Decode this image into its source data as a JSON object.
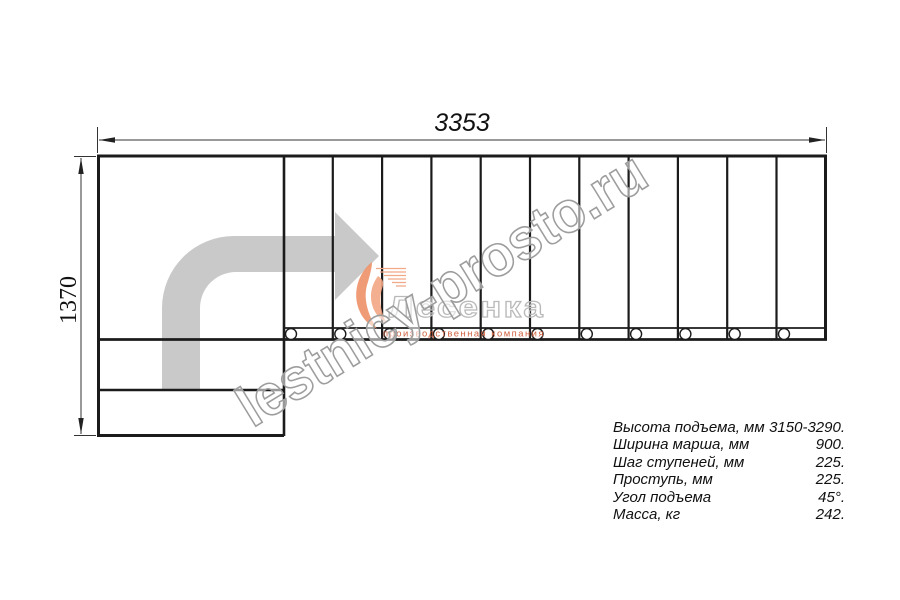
{
  "dimensions": {
    "width_mm": "3353",
    "height_mm": "1370"
  },
  "watermark": {
    "site": "lestnicy-prosto.ru"
  },
  "logo": {
    "name": "Лесенка",
    "tagline": "производственная компания"
  },
  "stairs": {
    "tread_count": 11,
    "baluster_count": 11,
    "turn": "90°"
  },
  "colors": {
    "line": "#1b1b1b",
    "arrow_fill": "#c9c9c9",
    "accent_orange": "#d2603f",
    "watermark_gray": "#9d9d9d"
  },
  "specs": {
    "rows": [
      {
        "label": "Высота подъема, мм",
        "value": "3150-3290."
      },
      {
        "label": "Ширина марша, мм",
        "value": "900."
      },
      {
        "label": "Шаг ступеней, мм",
        "value": "225."
      },
      {
        "label": "Проступь, мм",
        "value": "225."
      },
      {
        "label": "Угол подъема",
        "value": "45°."
      },
      {
        "label": "Масса, кг",
        "value": "242."
      }
    ]
  }
}
